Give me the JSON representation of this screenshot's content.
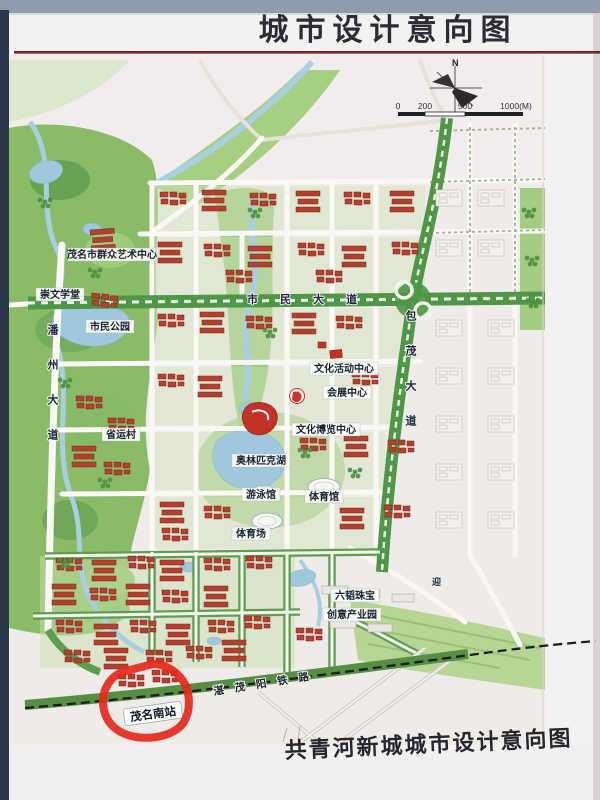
{
  "header": {
    "title": "城市设计意向图"
  },
  "compass": {
    "north": "N"
  },
  "scalebar": {
    "ticks": [
      "0",
      "200",
      "500",
      "1000(M)"
    ]
  },
  "map": {
    "labels": {
      "art_center": "茂名市群众艺术中心",
      "chongwen_school": "崇文学堂",
      "citizen_park": "市民公园",
      "panzhou_avenue": "潘州大道",
      "shimin_avenue": "市民大道",
      "baomao_avenue": "包茂大道",
      "culture_activity_center": "文化活动中心",
      "convention_center": "会展中心",
      "culture_expo_center": "文化博览中心",
      "olympic_lake": "奥林匹克湖",
      "swimming_hall": "游泳馆",
      "gymnasium": "体育馆",
      "stadium": "体育场",
      "provincial_games_village": "省运村",
      "jewelry_park_line1": "六韬珠宝",
      "jewelry_park_line2": "创意产业园",
      "railway": "湛茂阳铁路",
      "maoming_south_station": "茂名南站",
      "ying_road": "迎"
    }
  },
  "footer": {
    "subtitle": "共青河新城城市设计意向图"
  },
  "colors": {
    "highlight_red": "#e6281c",
    "title_underline": "#7a2025",
    "park_green": "#8abc68",
    "water_blue": "#9fc8dd",
    "roof_red": "#b4402f"
  }
}
